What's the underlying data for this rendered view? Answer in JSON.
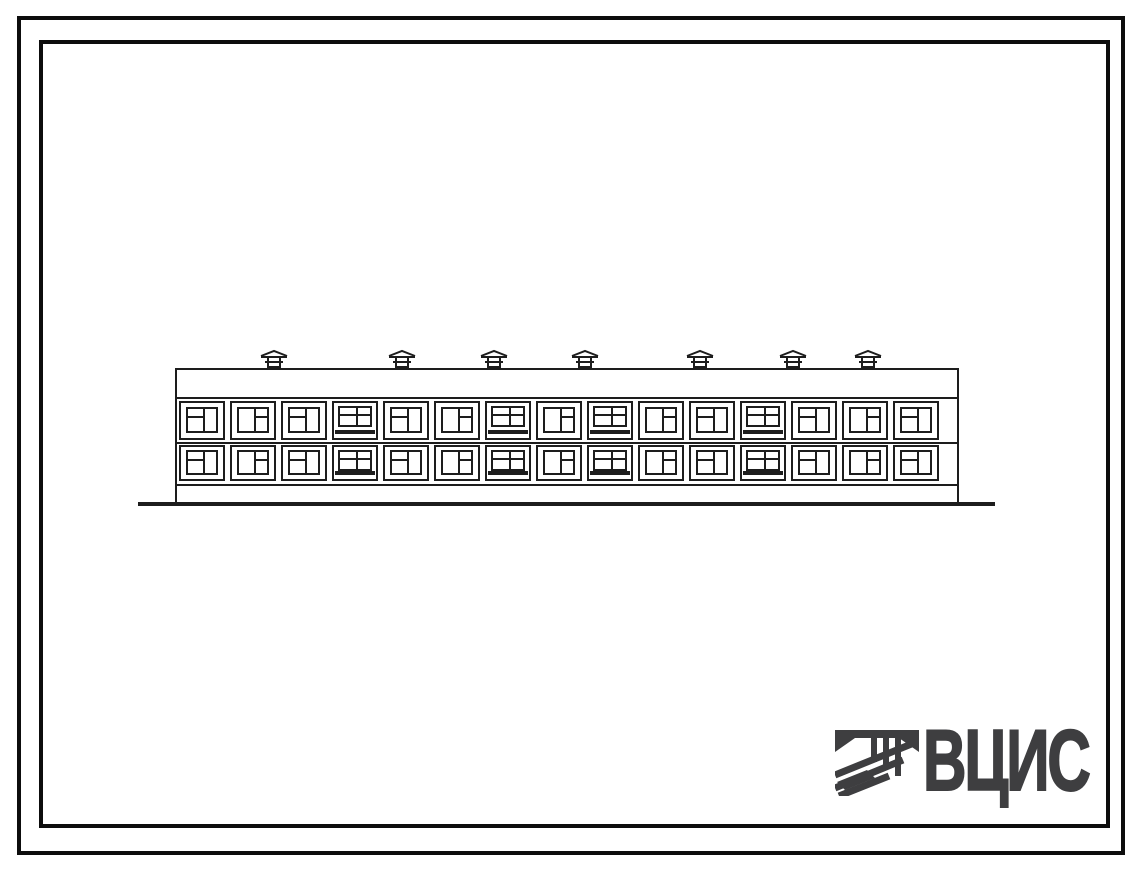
{
  "sheet": {
    "background": "#ffffff",
    "ink": "#1d1d1d"
  },
  "drawing": {
    "kind": "two-storey-building-facade-elevation",
    "floors": 2,
    "window_bays_per_floor": 15,
    "balcony_bay_indexes": [
      3,
      6,
      8,
      11
    ],
    "chimneys": {
      "count": 7,
      "centers_x": [
        274,
        402,
        494,
        585,
        700,
        793,
        868
      ]
    }
  },
  "logo": {
    "text": "ВЦИС",
    "color": "#3e3e40",
    "icon": "hatched-monogram-icon"
  }
}
